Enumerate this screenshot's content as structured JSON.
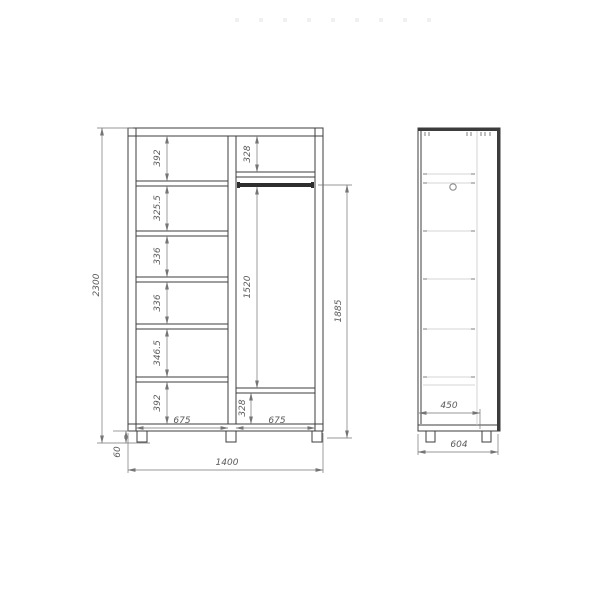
{
  "colors": {
    "line": "#3c3c3c",
    "dim_line": "#757575",
    "dim_text": "#5a5a5a",
    "light_line": "#c9c9c9",
    "rod": "#2e2e2e",
    "dot": "#f0f0f0"
  },
  "front_view": {
    "overall_height": "2300",
    "overall_width": "1400",
    "plinth_height": "60",
    "shelf_column": {
      "width": "675",
      "cells": [
        "392",
        "325.5",
        "336",
        "336",
        "346.5",
        "392"
      ]
    },
    "wardrobe_column": {
      "width": "675",
      "top_cell": "328",
      "rod_drop": "1520",
      "bottom_cell": "328",
      "rod_to_base": "1885"
    }
  },
  "side_view": {
    "base_depth": "450",
    "overall_depth": "604"
  }
}
